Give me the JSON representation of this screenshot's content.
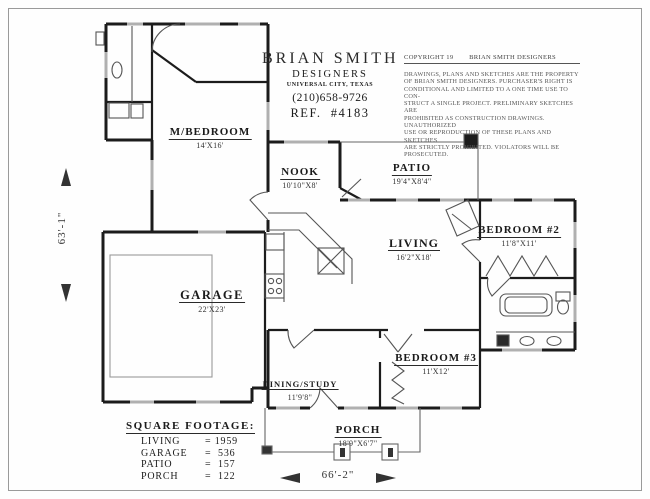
{
  "title_block": {
    "name": "BRIAN SMITH",
    "subtitle": "DESIGNERS",
    "city": "UNIVERSAL CITY, TEXAS",
    "phone": "(210)658-9726",
    "ref": "REF.  #4183"
  },
  "copyright": {
    "header_left": "COPYRIGHT 19",
    "header_right": "BRIAN  SMITH DESIGNERS",
    "lines": [
      "DRAWINGS, PLANS AND SKETCHES ARE THE PROPERTY",
      "OF BRIAN SMITH DESIGNERS.  PURCHASER'S RIGHT IS",
      "CONDITIONAL AND LIMITED TO A ONE TIME USE TO CON-",
      "STRUCT A SINGLE PROJECT.  PRELIMINARY SKETCHES ARE",
      "PROHIBITED AS CONSTRUCTION DRAWINGS.  UNAUTHORIZED",
      "USE OR REPRODUCTION OF THESE PLANS AND SKETCHES",
      "ARE STRICTLY PROHIBITED.  VIOLATORS WILL BE PROSECUTED."
    ]
  },
  "rooms": [
    {
      "name": "M/BEDROOM",
      "dims": "14'X16'"
    },
    {
      "name": "NOOK",
      "dims": "10'10\"X8'"
    },
    {
      "name": "PATIO",
      "dims": "19'4\"X8'4\""
    },
    {
      "name": "LIVING",
      "dims": "16'2\"X18'"
    },
    {
      "name": "BEDROOM  #2",
      "dims": "11'8\"X11'"
    },
    {
      "name": "GARAGE",
      "dims": "22'X23'"
    },
    {
      "name": "DINING/STUDY",
      "dims": "11'9'8\""
    },
    {
      "name": "BEDROOM  #3",
      "dims": "11'X12'"
    },
    {
      "name": "PORCH",
      "dims": "18'9\"X6'7\""
    }
  ],
  "square_footage": {
    "title": "SQUARE FOOTAGE:",
    "rows": [
      {
        "label": "LIVING",
        "value": "= 1959"
      },
      {
        "label": "GARAGE",
        "value": "=  536"
      },
      {
        "label": "PATIO",
        "value": "=  157"
      },
      {
        "label": "PORCH",
        "value": "=  122"
      }
    ]
  },
  "dimensions": {
    "width": "66'-2\"",
    "height": "63'-1\""
  },
  "colors": {
    "wall": "#1c1c1c",
    "window": "#b0b0b0",
    "thin_line": "#555555",
    "paper": "#fefefe"
  }
}
